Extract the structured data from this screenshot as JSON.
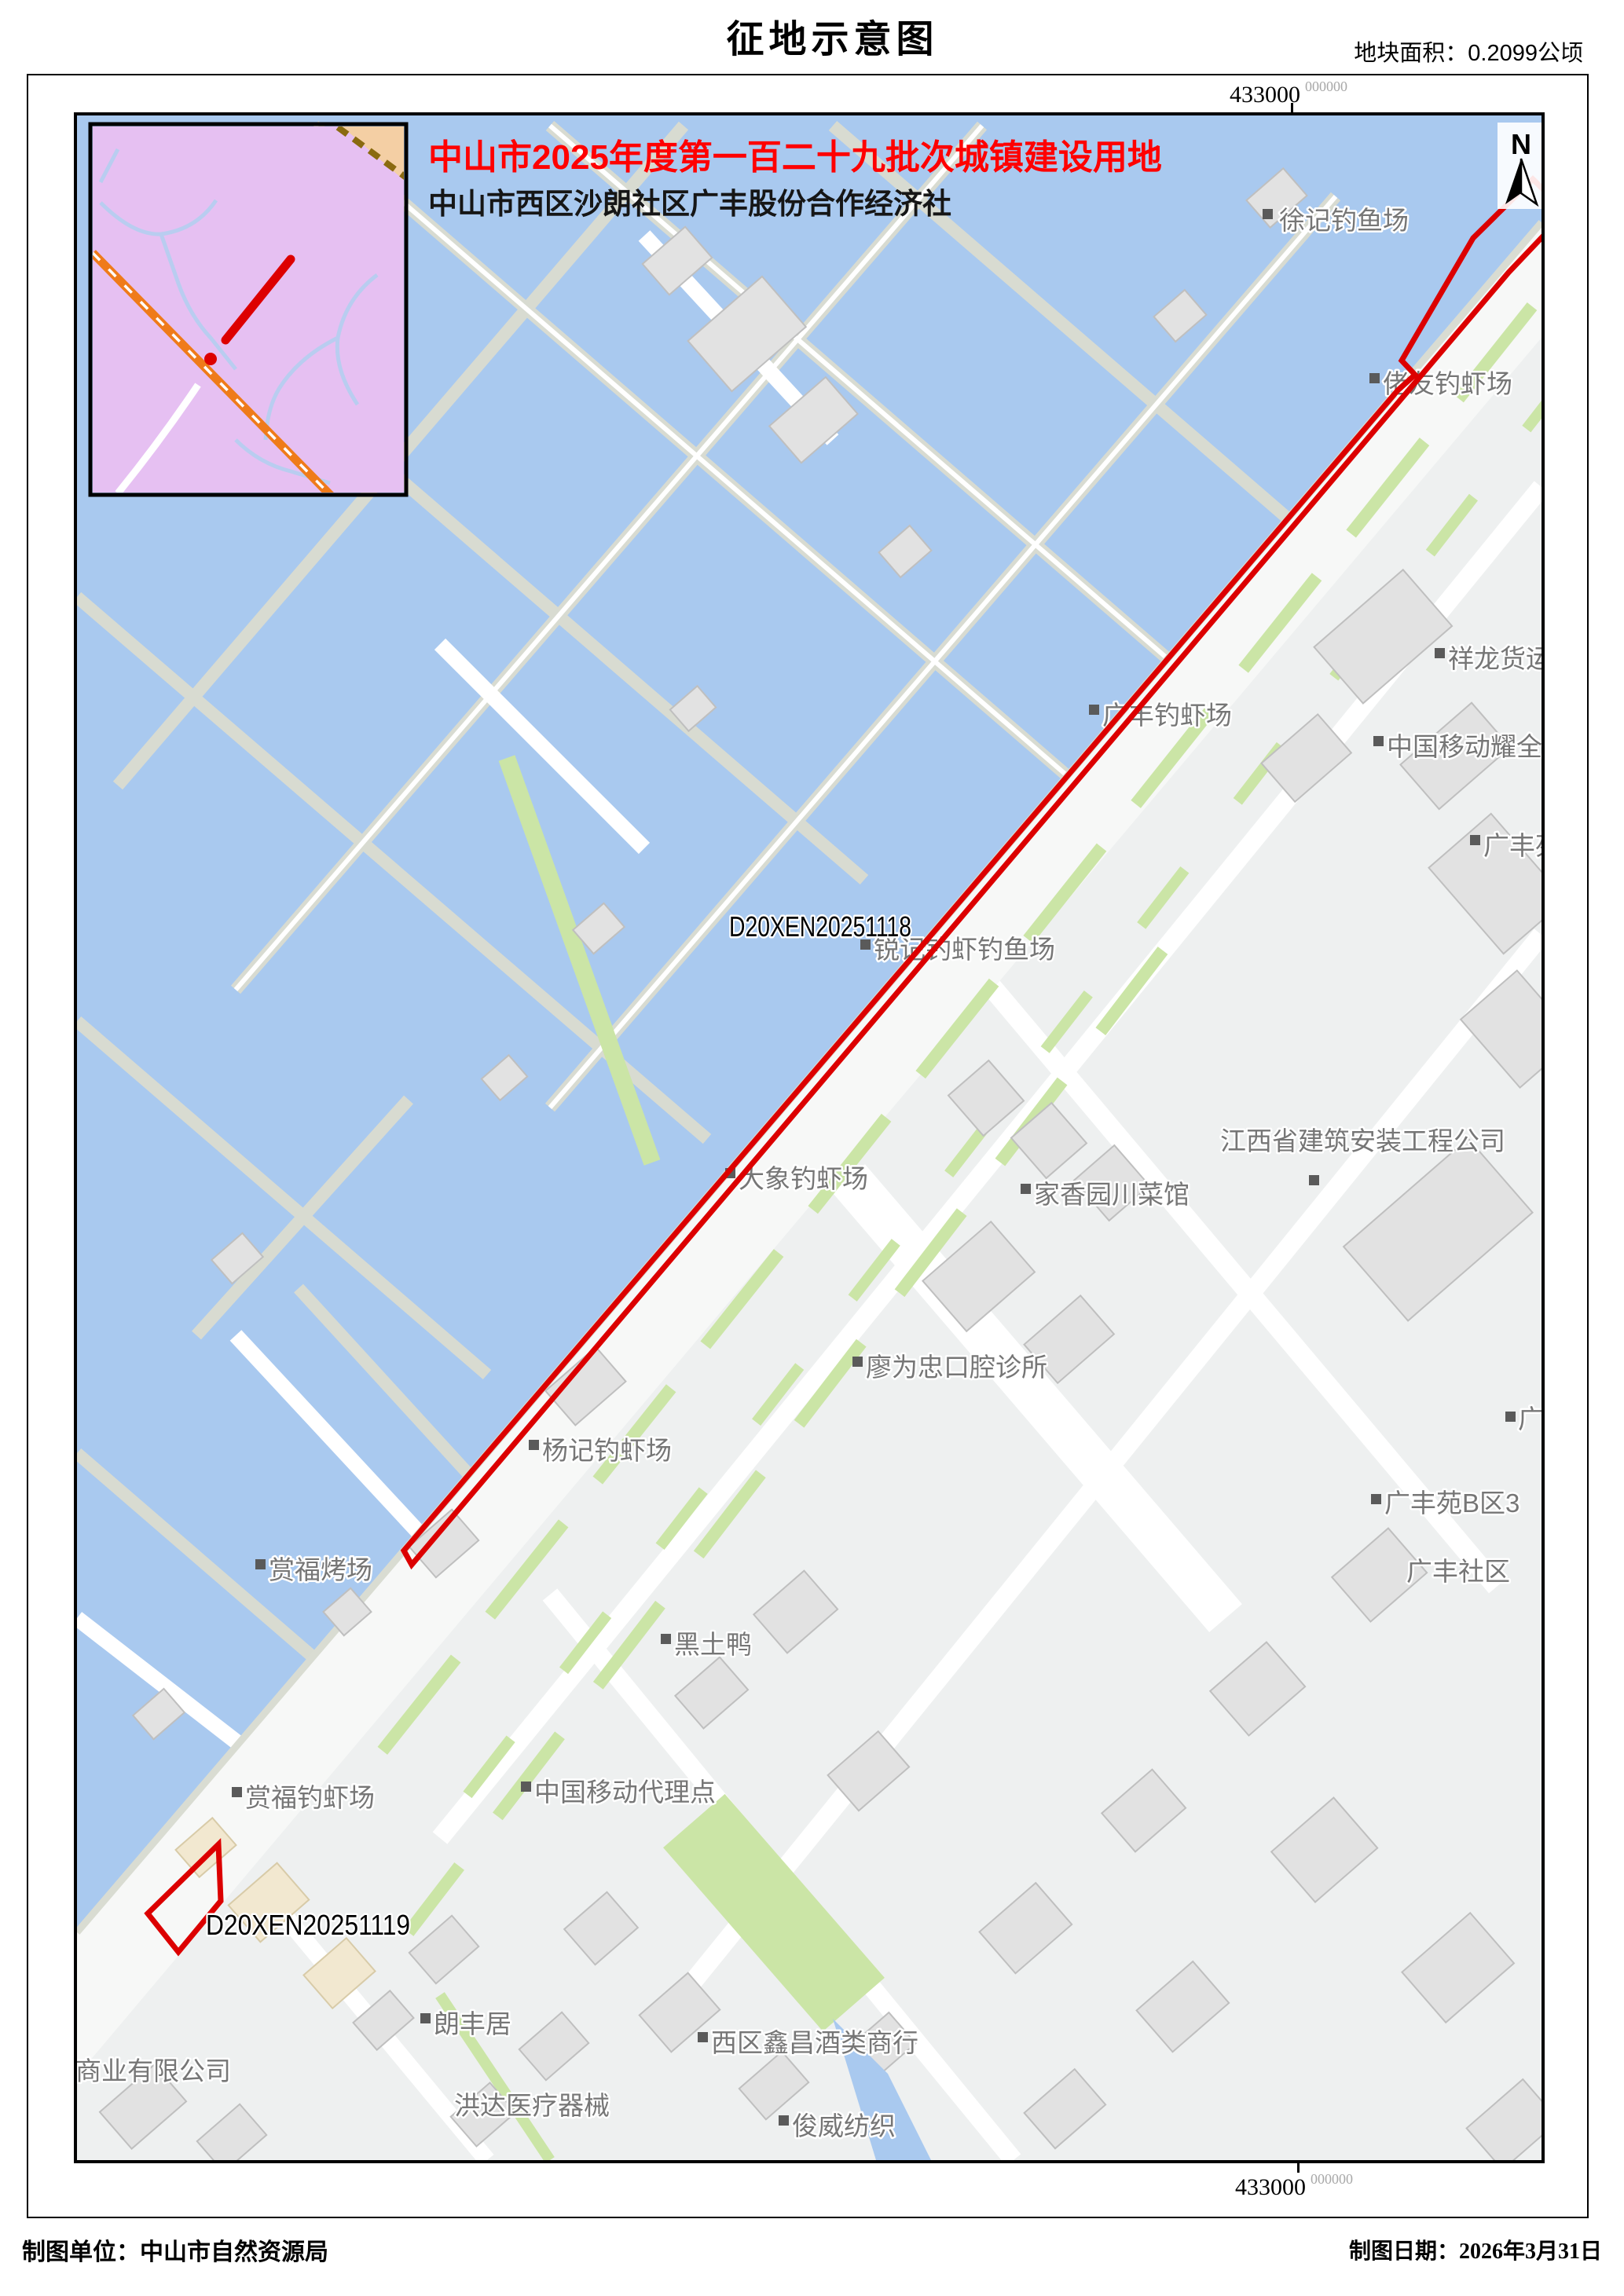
{
  "page": {
    "title": "征地示意图",
    "area_label": "地块面积：0.2099公顷",
    "footer_left": "制图单位：中山市自然资源局",
    "footer_right": "制图日期：2026年3月31日"
  },
  "header_note": {
    "line1": "中山市2025年度第一百二十九批次城镇建设用地",
    "line2": "中山市西区沙朗社区广丰股份合作经济社"
  },
  "coordinates": {
    "top": {
      "main": "433000",
      "sup": "000000"
    },
    "bottom": {
      "main": "433000",
      "sup": "000000"
    }
  },
  "north_arrow": {
    "label": "N"
  },
  "parcels": [
    {
      "id": "D20XEN20251118"
    },
    {
      "id": "D20XEN20251119"
    }
  ],
  "map_labels": [
    {
      "text": "徐记钓鱼场"
    },
    {
      "text": "佬友钓虾场"
    },
    {
      "text": "广丰钓虾场"
    },
    {
      "text": "祥龙货运"
    },
    {
      "text": "中国移动耀全"
    },
    {
      "text": "广丰苑"
    },
    {
      "text": "锐记钓虾钓鱼场"
    },
    {
      "text": "家香园川菜馆"
    },
    {
      "text": "江西省建筑安装工程公司"
    },
    {
      "text": "大象钓虾场"
    },
    {
      "text": "廖为忠口腔诊所"
    },
    {
      "text": "杨记钓虾场"
    },
    {
      "text": "赏福烤场"
    },
    {
      "text": "黑土鸭"
    },
    {
      "text": "广丰"
    },
    {
      "text": "广丰苑B区3"
    },
    {
      "text": "广丰社区"
    },
    {
      "text": "赏福钓虾场"
    },
    {
      "text": "中国移动代理点"
    },
    {
      "text": "朗丰居"
    },
    {
      "text": "西区鑫昌酒类商行"
    },
    {
      "text": "商业有限公司"
    },
    {
      "text": "洪达医疗器械"
    },
    {
      "text": "俊威纺织"
    }
  ],
  "colors": {
    "parcel_outline": "#dc0000",
    "batch_title_red": "#ff0000",
    "water": "#a9c9ef",
    "green": "#cbe5a6",
    "road": "#f7f8f7",
    "urban_land": "#eef0f0",
    "building_fill": "#e2e2e2",
    "label_gray": "#767676",
    "inset_bg": "#e6c0f2",
    "inset_road_orange": "#ef7b1a",
    "inset_rail_brown": "#8a6a10"
  }
}
